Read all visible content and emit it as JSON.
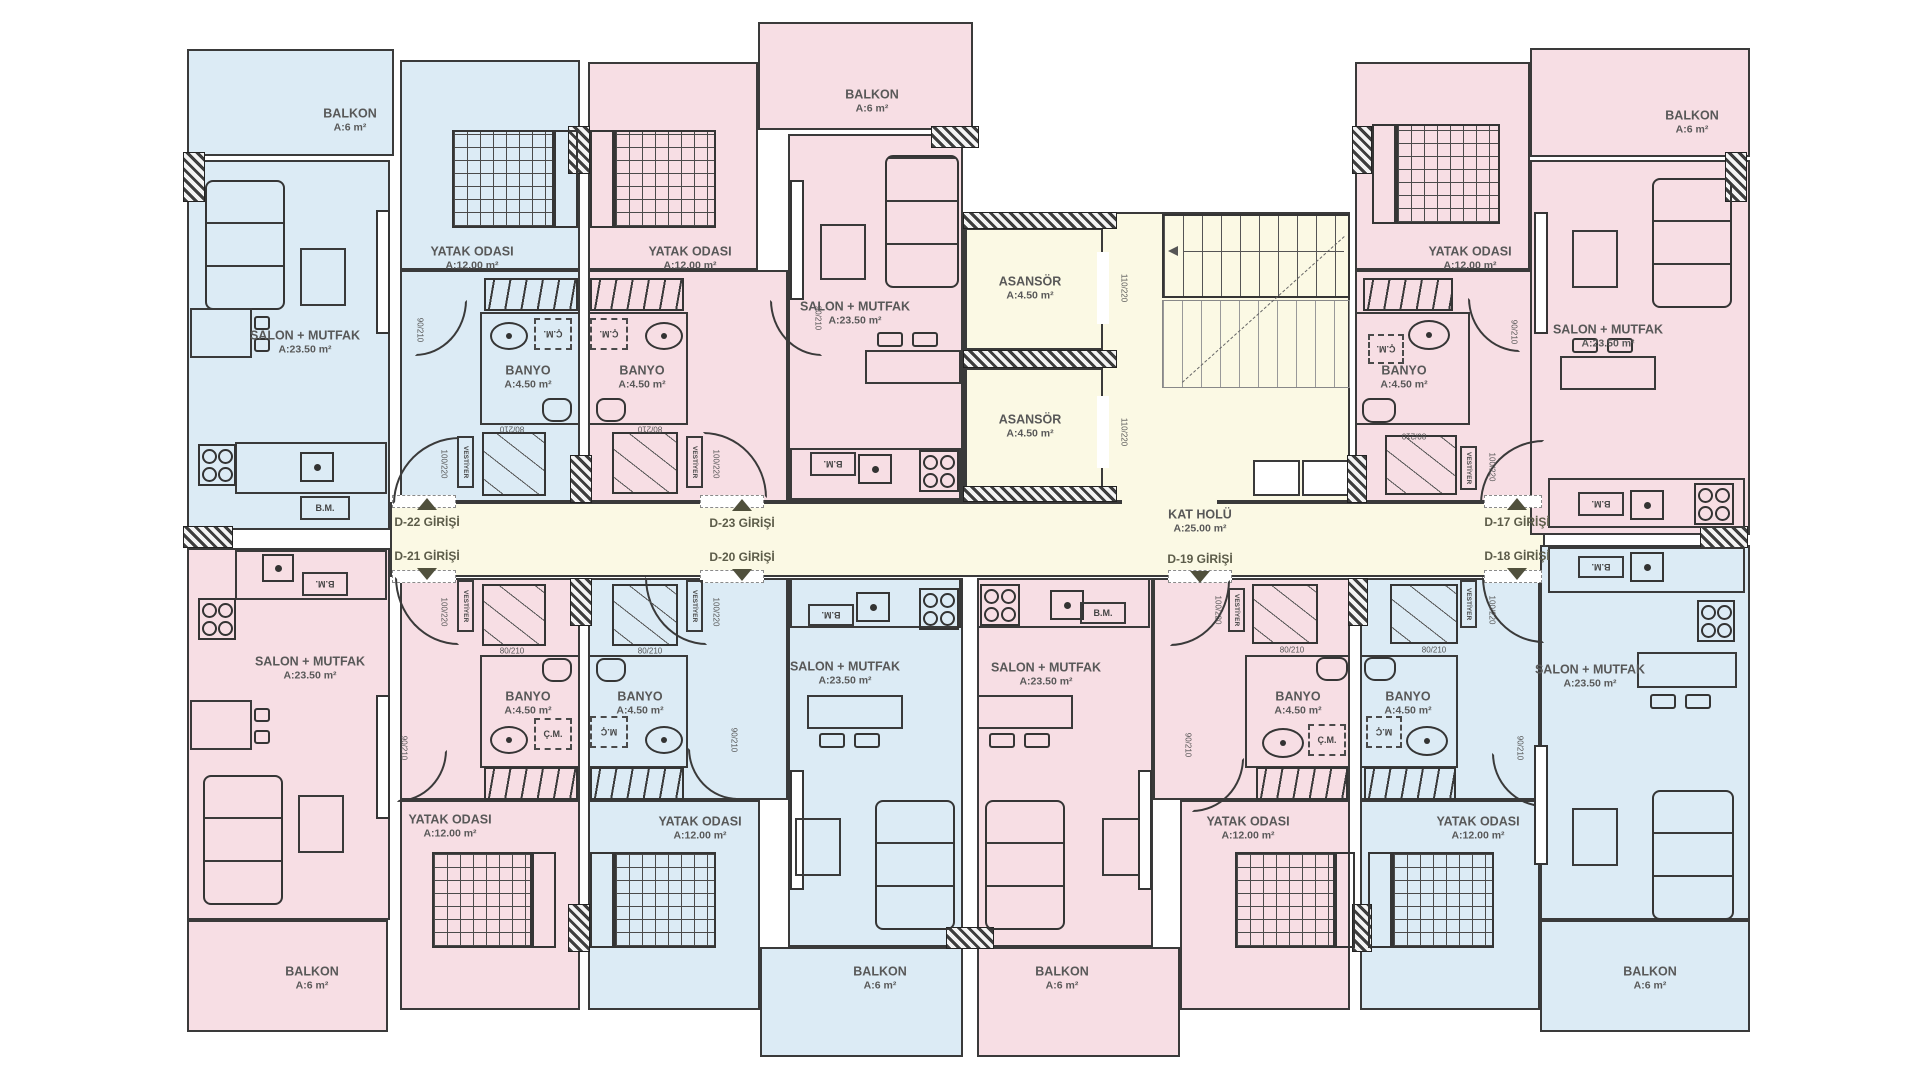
{
  "drawing": {
    "kind": "apartment-building-typical-floor-plan"
  },
  "colors": {
    "apartment_pink": "#f7dee4",
    "apartment_blue": "#dcebf5",
    "core_yellow": "#fbf9e4",
    "wall": "#3a3a3a",
    "room_text": "#585858",
    "corridor_text": "#5c5c49"
  },
  "labels": {
    "balkon": "BALKON",
    "balkon_area": "A:6 m²",
    "salon": "SALON + MUTFAK",
    "salon_area": "A:23.50 m²",
    "yatak": "YATAK ODASI",
    "yatak_area": "A:12.00 m²",
    "banyo": "BANYO",
    "banyo_area": "A:4.50 m²",
    "asansor": "ASANSÖR",
    "asansor_area": "A:4.50 m²",
    "kat_holu": "KAT HOLÜ",
    "kat_holu_area": "A:25.00 m²",
    "bm": "B.M.",
    "cm": "Ç.M.",
    "mc": "M.Ç",
    "vestiyer": "VESTİYER",
    "dim_90": "90/210",
    "dim_80": "80/210",
    "dim_100": "100/220",
    "dim_110": "110/220"
  },
  "entrances": {
    "d17": "D-17 GİRİŞİ",
    "d18": "D-18 GİRİŞİ",
    "d19": "D-19 GİRİŞİ",
    "d20": "D-20 GİRİŞİ",
    "d21": "D-21 GİRİŞİ",
    "d22": "D-22 GİRİŞİ",
    "d23": "D-23 GİRİŞİ"
  }
}
